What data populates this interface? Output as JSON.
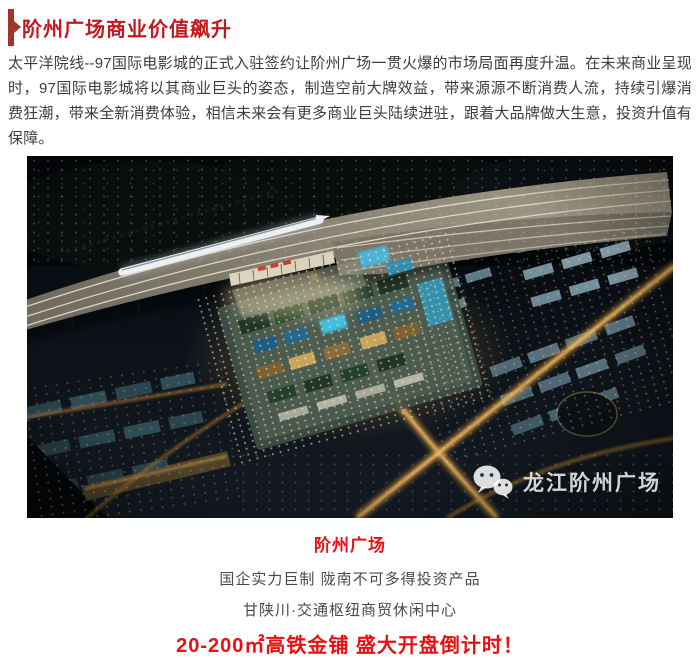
{
  "colors": {
    "title_red": "#c2191f",
    "accent_bar_red": "#a03528",
    "cta_red": "#ec0f12",
    "paragraph_gray": "#3d3d3d",
    "footer_gray": "#4a4a4a"
  },
  "header": {
    "title": "阶州广场商业价值飙升"
  },
  "paragraph": {
    "text": "太平洋院线--97国际电影城的正式入驻签约让阶州广场一贯火爆的市场局面再度升温。在未来商业呈现时，97国际电影城将以其商业巨头的姿态，制造空前大牌效益，带来源源不断消费人流，持续引爆消费狂潮，带来全新消费体验，相信未来会有更多商业巨头陆续进驻，跟着大品牌做大生意，投资升值有保障。"
  },
  "hero": {
    "watermark": {
      "icon": "wechat-icon",
      "text": "龙江阶州广场"
    }
  },
  "footer": {
    "project_name": "阶州广场",
    "line1": "国企实力巨制 陇南不可多得投资产品",
    "line2": "甘陕川·交通枢纽商贸休闲中心",
    "cta": "20-200㎡高铁金铺 盛大开盘倒计时！"
  }
}
